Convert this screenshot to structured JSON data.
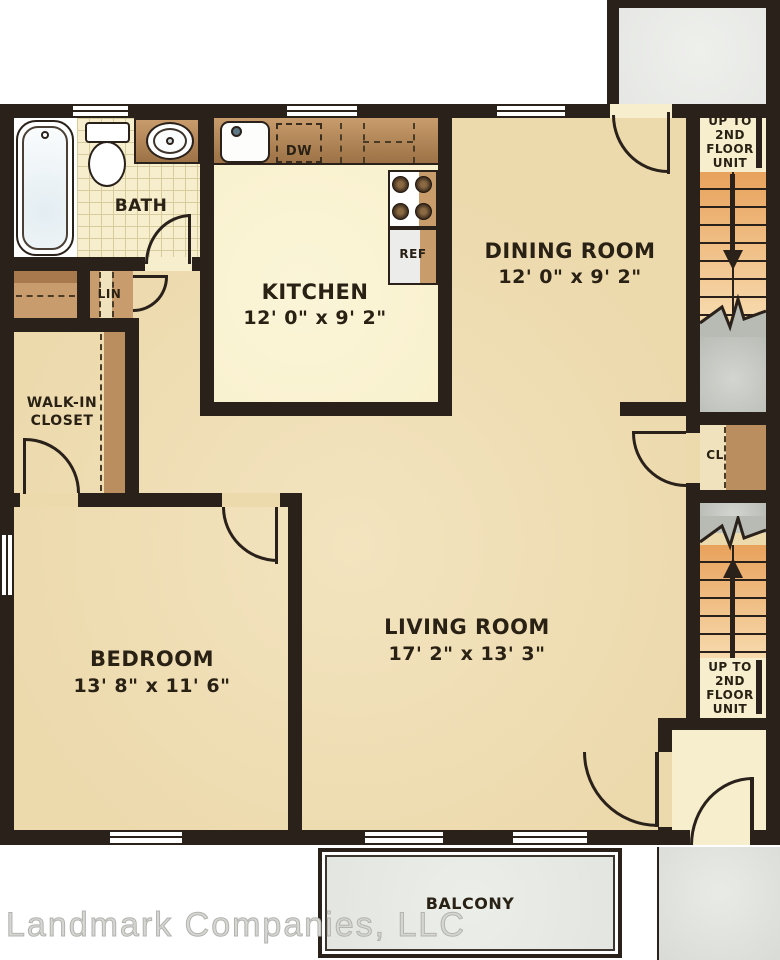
{
  "watermark": {
    "text": "Landmark Companies, LLC"
  },
  "rooms": {
    "bath": {
      "name": "BATH"
    },
    "kitchen": {
      "name": "KITCHEN",
      "dims": "12' 0\" x 9' 2\""
    },
    "dining": {
      "name": "DINING ROOM",
      "dims": "12' 0\" x 9' 2\""
    },
    "living": {
      "name": "LIVING ROOM",
      "dims": "17' 2\" x 13' 3\""
    },
    "bedroom": {
      "name": "BEDROOM",
      "dims": "13' 8\" x 11' 6\""
    },
    "walkin_closet": {
      "line1": "WALK-IN",
      "line2": "CLOSET"
    },
    "linen_closet": {
      "name": "LIN"
    },
    "hall_closet": {
      "name": "CL"
    },
    "balcony": {
      "name": "BALCONY"
    }
  },
  "stairs": {
    "upper": {
      "lines": [
        "UP TO",
        "2ND",
        "FLOOR",
        "UNIT"
      ]
    },
    "lower": {
      "lines": [
        "UP TO",
        "2ND",
        "FLOOR",
        "UNIT"
      ]
    }
  },
  "appliances": {
    "dishwasher": "DW",
    "refrigerator": "REF"
  },
  "colors": {
    "wall": "#29211a",
    "floor": "#ecd9ac",
    "kitchen_floor": "#f8f0cb",
    "tile": "#f6eecd",
    "tile_line": "#d8cb9e",
    "counter_dark": "#9c7246",
    "counter_light": "#c99c6c",
    "shelf": "#bb8e60",
    "closet_brown": "#c89c6c",
    "stair_dark": "#e8a25c",
    "stair_light": "#f7daad",
    "gray_dark": "#b7bbb4",
    "gray_light": "#d3d6d0",
    "porch": "#e6e7e4",
    "balcony": "#e3e5e1",
    "ink": "#2a2115",
    "watermark": "#d6d6d3"
  }
}
